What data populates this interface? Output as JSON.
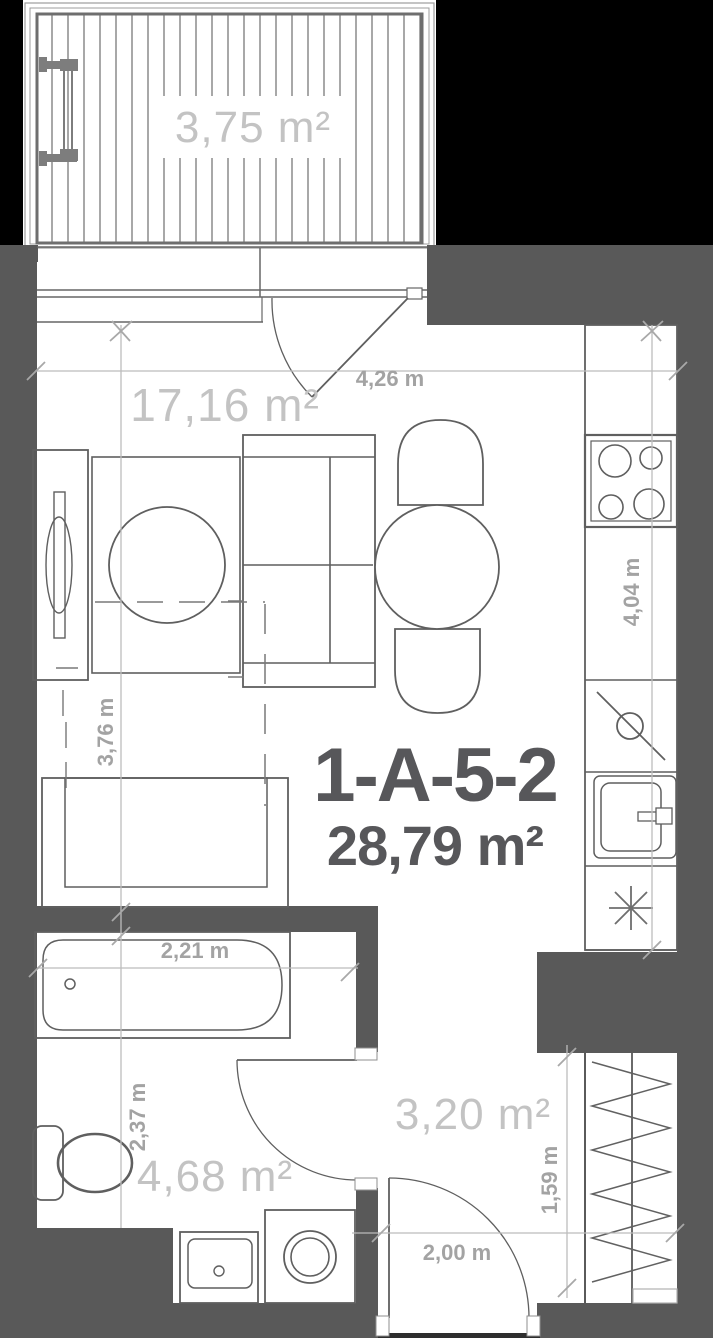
{
  "plan": {
    "title": "1-A-5-2",
    "total_area": "28,79 m²",
    "areas": {
      "balcony": "3,75 m²",
      "living": "17,16 m²",
      "bathroom": "4,68 m²",
      "hallway": "3,20 m²"
    },
    "dims": {
      "living_width": "4,26 m",
      "kitchen_run": "4,04 m",
      "living_depth": "3,76 m",
      "bathroom_width": "2,21 m",
      "bathroom_depth": "2,37 m",
      "hallway_width": "2,00 m",
      "hallway_depth": "1,59 m"
    },
    "colors": {
      "background": "#000000",
      "wall": "#595959",
      "furniture_line": "#5f5f5f",
      "dimension_line": "#bcbcbc",
      "dimension_label": "#a3a3a3",
      "area_label": "#c3c3c3",
      "unit_label": "#57575a"
    }
  }
}
